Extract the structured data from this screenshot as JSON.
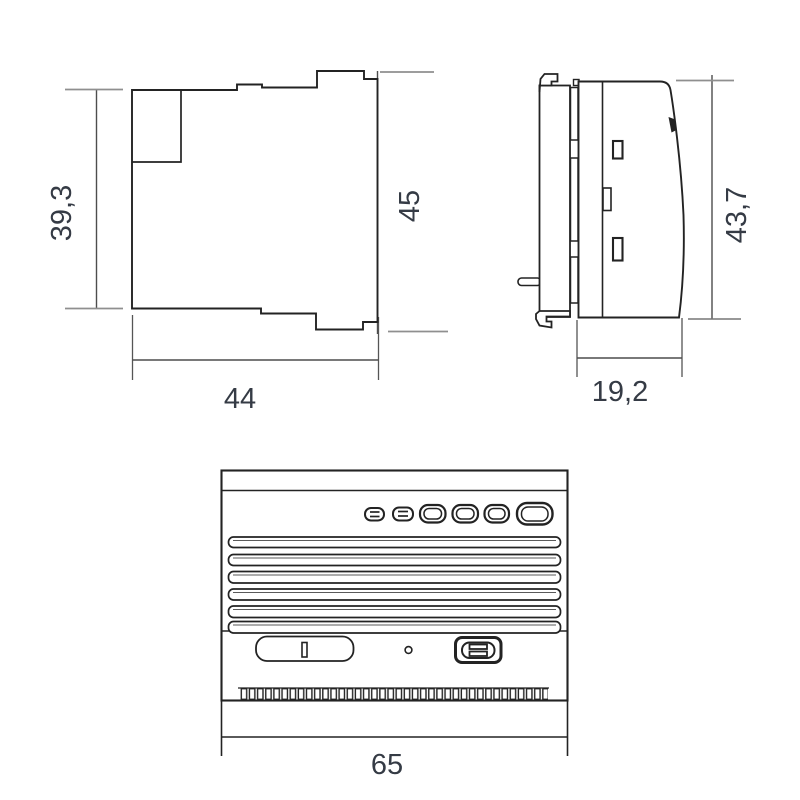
{
  "drawing": {
    "type": "technical-dimension-drawing",
    "views": [
      {
        "id": "outline-view",
        "name": "module outline view (top left)"
      },
      {
        "id": "side-profile-view",
        "name": "side profile view with DIN-rail clip (top right)"
      },
      {
        "id": "panel-face-view",
        "name": "front panel face view (bottom)"
      }
    ],
    "dimensions": {
      "outline_height": "39,3",
      "outline_width": "44",
      "outline_overall_height": "45",
      "side_depth": "19,2",
      "side_height": "43,7",
      "panel_width": "65"
    },
    "colors": {
      "line": "#232323",
      "dim_line": "#4d4d4d",
      "extension_line": "#8f8f8f",
      "label_text": "#353b45",
      "background": "#ffffff"
    }
  }
}
